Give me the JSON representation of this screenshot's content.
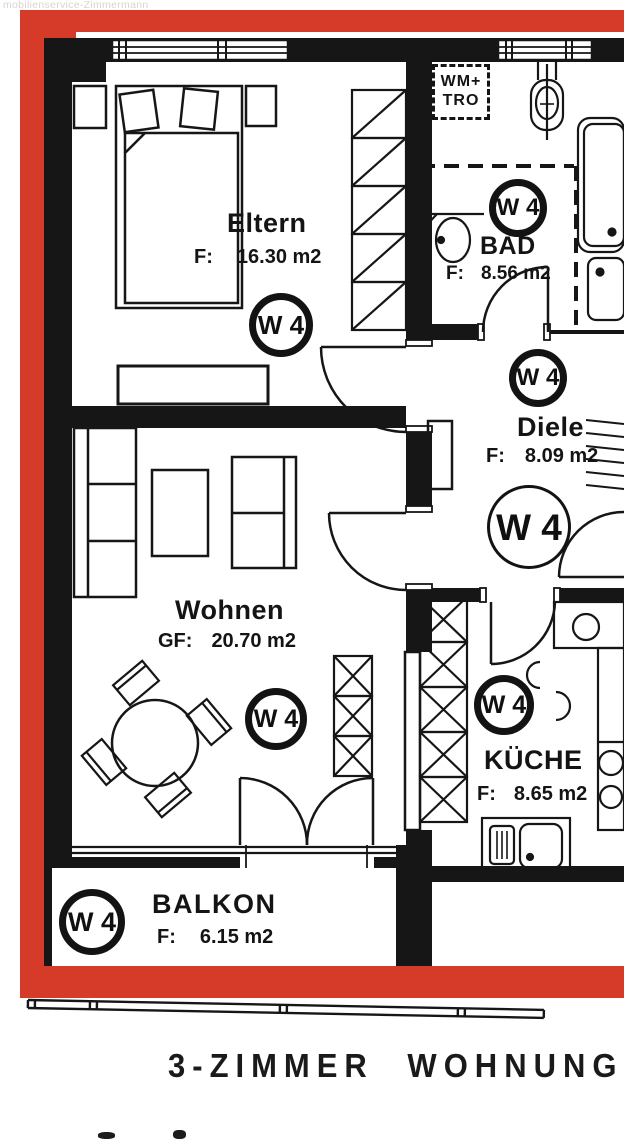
{
  "watermark": "mobilienservice-Zimmermann",
  "title": "3-ZIMMER WOHNUNG",
  "unit_label": "W 4",
  "laundry_box": {
    "line1": "WM+",
    "line2": "TRO"
  },
  "rooms": {
    "eltern": {
      "name": "Eltern",
      "area_label": "F:",
      "area_value": "16.30 m2"
    },
    "bad": {
      "name": "BAD",
      "area_label": "F:",
      "area_value": "8.56 m2"
    },
    "diele": {
      "name": "Diele",
      "area_label": "F:",
      "area_value": "8.09 m2"
    },
    "wohnen": {
      "name": "Wohnen",
      "area_label": "GF:",
      "area_value": "20.70 m2"
    },
    "kueche": {
      "name": "KÜCHE",
      "area_label": "F:",
      "area_value": "8.65 m2"
    },
    "balkon": {
      "name": "BALKON",
      "area_label": "F:",
      "area_value": "6.15 m2"
    }
  },
  "colors": {
    "frame_red": "#d63b2a",
    "wall_black": "#161616",
    "paper": "#ffffff"
  }
}
